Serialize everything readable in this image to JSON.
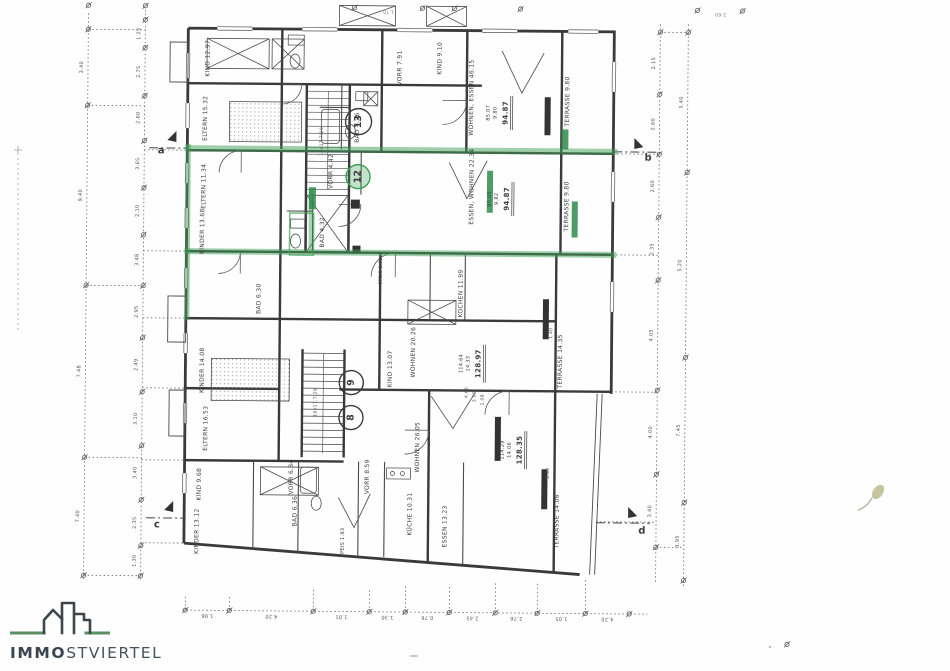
{
  "logo": {
    "brand_bold": "IMMO",
    "brand_rest": "STVIERTEL"
  },
  "colors": {
    "ink": "#3c3c3c",
    "dim": "#555555",
    "highlight_green": "#3f9f55",
    "logo_green": "#5d8f62"
  },
  "plan": {
    "texts": [
      {
        "t": "KIND 12.97",
        "x": 206,
        "y": 60,
        "r": -90,
        "n": "room-label"
      },
      {
        "t": "ELTERN 15.32",
        "x": 204,
        "y": 120,
        "r": -90,
        "n": "room-label"
      },
      {
        "t": "ELTERN 11.34",
        "x": 203,
        "y": 188,
        "r": -90,
        "n": "room-label"
      },
      {
        "t": "KINDER 13.68",
        "x": 202,
        "y": 233,
        "r": -90,
        "n": "room-label"
      },
      {
        "t": "KINDER 14.08",
        "x": 203,
        "y": 372,
        "r": -90,
        "n": "room-label"
      },
      {
        "t": "ELTERN 16.53",
        "x": 207,
        "y": 430,
        "r": -90,
        "n": "room-label"
      },
      {
        "t": "KIND 9.68",
        "x": 201,
        "y": 486,
        "r": -90,
        "n": "room-label"
      },
      {
        "t": "KINDER 13.12",
        "x": 199,
        "y": 533,
        "r": -90,
        "n": "room-label"
      },
      {
        "t": "BAD 6.30",
        "x": 259,
        "y": 300,
        "r": -90,
        "n": "room-label"
      },
      {
        "t": "BAD 6.36",
        "x": 297,
        "y": 512,
        "r": -90,
        "n": "room-label"
      },
      {
        "t": "VORR 6.34",
        "x": 293,
        "y": 478,
        "r": -90,
        "n": "room-label"
      },
      {
        "t": "VORR 8.59",
        "x": 369,
        "y": 477,
        "r": -90,
        "n": "room-label"
      },
      {
        "t": "SPEIS 1.93",
        "x": 345,
        "y": 543,
        "r": -90,
        "s": 5,
        "n": "room-label"
      },
      {
        "t": "KÜCHE 10.31",
        "x": 412,
        "y": 514,
        "r": -90,
        "n": "room-label"
      },
      {
        "t": "ESSEN 13.23",
        "x": 447,
        "y": 526,
        "r": -90,
        "n": "room-label"
      },
      {
        "t": "WOHNEN 26.05",
        "x": 419,
        "y": 447,
        "r": -90,
        "n": "room-label"
      },
      {
        "t": "WOHNEN 20.26",
        "x": 414,
        "y": 352,
        "r": -90,
        "n": "room-label"
      },
      {
        "t": "KIND 13.07",
        "x": 391,
        "y": 369,
        "r": -90,
        "n": "room-label"
      },
      {
        "t": "KOCHEN 11.99",
        "x": 461,
        "y": 293,
        "r": -90,
        "n": "room-label"
      },
      {
        "t": "SPEIS 1.90",
        "x": 381,
        "y": 271,
        "r": -90,
        "s": 4.5,
        "n": "room-label"
      },
      {
        "t": "VORR 4.42",
        "x": 330,
        "y": 172,
        "r": -90,
        "n": "room-label"
      },
      {
        "t": "BAD 4.32",
        "x": 322,
        "y": 233,
        "r": -90,
        "n": "room-label"
      },
      {
        "t": "ESSEN, WOHNEN 22.34",
        "x": 471,
        "y": 186,
        "r": -90,
        "n": "room-label"
      },
      {
        "t": "WOHNEN, ESSEN 46.15",
        "x": 470,
        "y": 97,
        "r": -90,
        "n": "room-label"
      },
      {
        "t": "KIND 9.10",
        "x": 438,
        "y": 58,
        "r": -90,
        "n": "room-label"
      },
      {
        "t": "VORR 7.91",
        "x": 398,
        "y": 68,
        "r": -90,
        "n": "room-label"
      },
      {
        "t": "BAD 4.26",
        "x": 356,
        "y": 128,
        "r": -90,
        "n": "room-label"
      },
      {
        "t": "TERRASSE 9.80",
        "x": 566,
        "y": 100,
        "r": -90,
        "n": "room-label"
      },
      {
        "t": "TERRASSE 9.80",
        "x": 566,
        "y": 205,
        "r": -90,
        "n": "room-label"
      },
      {
        "t": "TERRASSE 14.35",
        "x": 561,
        "y": 360,
        "r": -90,
        "n": "room-label"
      },
      {
        "t": "TERRASSE 14.06",
        "x": 559,
        "y": 520,
        "r": -90,
        "n": "room-label"
      },
      {
        "t": "16x17.7/29",
        "x": 321,
        "y": 142,
        "r": -90,
        "s": 4.5,
        "c": "#555555",
        "n": "stair-note"
      },
      {
        "t": "16x17.7/29",
        "x": 317,
        "y": 403,
        "r": -90,
        "s": 4.5,
        "c": "#555555",
        "n": "stair-note"
      },
      {
        "t": "85.07",
        "x": 487,
        "y": 112,
        "r": -90,
        "s": 5,
        "n": "area-sum"
      },
      {
        "t": "9.80",
        "x": 494,
        "y": 112,
        "r": -90,
        "s": 5,
        "n": "area-sum"
      },
      {
        "t": "94.87",
        "x": 504,
        "y": 112,
        "r": -90,
        "s": 7,
        "w": 1,
        "n": "area-total"
      },
      {
        "t": "85.05",
        "x": 489,
        "y": 198,
        "r": -90,
        "s": 5,
        "n": "area-sum"
      },
      {
        "t": "9.82",
        "x": 496,
        "y": 198,
        "r": -90,
        "s": 5,
        "n": "area-sum"
      },
      {
        "t": "94.87",
        "x": 506,
        "y": 198,
        "r": -90,
        "s": 7,
        "w": 1,
        "n": "area-total"
      },
      {
        "t": "114.64",
        "x": 462,
        "y": 363,
        "r": -90,
        "s": 5,
        "n": "area-sum"
      },
      {
        "t": "14.33",
        "x": 469,
        "y": 363,
        "r": -90,
        "s": 5,
        "n": "area-sum"
      },
      {
        "t": "128.97",
        "x": 479,
        "y": 363,
        "r": -90,
        "s": 7,
        "w": 1,
        "n": "area-total"
      },
      {
        "t": "114.29",
        "x": 504,
        "y": 449,
        "r": -90,
        "s": 5,
        "n": "area-sum"
      },
      {
        "t": "14.06",
        "x": 511,
        "y": 449,
        "r": -90,
        "s": 5,
        "n": "area-sum"
      },
      {
        "t": "128.35",
        "x": 521,
        "y": 449,
        "r": -90,
        "s": 7,
        "w": 1,
        "n": "area-total"
      },
      {
        "t": "a",
        "x": 160,
        "y": 153,
        "s": 10,
        "w": 1,
        "n": "section-marker-a"
      },
      {
        "t": "b",
        "x": 647,
        "y": 156,
        "s": 10,
        "w": 1,
        "n": "section-marker-b"
      },
      {
        "t": "c",
        "x": 159,
        "y": 527,
        "s": 10,
        "w": 1,
        "n": "section-marker-c"
      },
      {
        "t": "d",
        "x": 644,
        "y": 529,
        "s": 10,
        "w": 1,
        "n": "section-marker-d"
      },
      {
        "t": "4.66",
        "x": 468,
        "y": 392,
        "r": -90,
        "s": 4.5,
        "c": "#555555",
        "n": "dim-label"
      },
      {
        "t": "3.00",
        "x": 476,
        "y": 396,
        "r": -90,
        "s": 4.5,
        "c": "#555555",
        "n": "dim-label"
      },
      {
        "t": "2.08",
        "x": 484,
        "y": 399,
        "r": -90,
        "s": 4.5,
        "c": "#555555",
        "n": "dim-label"
      },
      {
        "t": "1.40",
        "x": 552,
        "y": 332,
        "r": -90,
        "s": 4.5,
        "c": "#555555",
        "n": "dim-label"
      },
      {
        "t": "1.40",
        "x": 550,
        "y": 472,
        "r": -90,
        "s": 4.5,
        "c": "#555555",
        "n": "dim-label"
      },
      {
        "t": "1.25",
        "x": 137,
        "y": 36,
        "r": -90,
        "s": 5,
        "c": "#555555",
        "n": "dim-label"
      },
      {
        "t": "2.75",
        "x": 137,
        "y": 74,
        "r": -90,
        "s": 5,
        "c": "#555555",
        "n": "dim-label"
      },
      {
        "t": "2.60",
        "x": 137,
        "y": 120,
        "r": -90,
        "s": 5,
        "c": "#555555",
        "n": "dim-label"
      },
      {
        "t": "3.65",
        "x": 137,
        "y": 166,
        "r": -90,
        "s": 5,
        "c": "#555555",
        "n": "dim-label"
      },
      {
        "t": "2.10",
        "x": 137,
        "y": 213,
        "r": -90,
        "s": 5,
        "c": "#555555",
        "n": "dim-label"
      },
      {
        "t": "3.48",
        "x": 137,
        "y": 262,
        "r": -90,
        "s": 5,
        "c": "#555555",
        "n": "dim-label"
      },
      {
        "t": "2.95",
        "x": 137,
        "y": 314,
        "r": -90,
        "s": 5,
        "c": "#555555",
        "n": "dim-label"
      },
      {
        "t": "2.49",
        "x": 137,
        "y": 367,
        "r": -90,
        "s": 5,
        "c": "#555555",
        "n": "dim-label"
      },
      {
        "t": "3.10",
        "x": 137,
        "y": 421,
        "r": -90,
        "s": 5,
        "c": "#555555",
        "n": "dim-label"
      },
      {
        "t": "3.40",
        "x": 137,
        "y": 475,
        "r": -90,
        "s": 5,
        "c": "#555555",
        "n": "dim-label"
      },
      {
        "t": "2.35",
        "x": 137,
        "y": 525,
        "r": -90,
        "s": 5,
        "c": "#555555",
        "n": "dim-label"
      },
      {
        "t": "1.30",
        "x": 137,
        "y": 563,
        "r": -90,
        "s": 5,
        "c": "#555555",
        "n": "dim-label"
      },
      {
        "t": "3.40",
        "x": 80,
        "y": 70,
        "r": -90,
        "s": 5,
        "c": "#555555",
        "n": "dim-label"
      },
      {
        "t": "9.40",
        "x": 80,
        "y": 198,
        "r": -90,
        "s": 5,
        "c": "#555555",
        "n": "dim-label"
      },
      {
        "t": "7.48",
        "x": 80,
        "y": 374,
        "r": -90,
        "s": 5,
        "c": "#555555",
        "n": "dim-label"
      },
      {
        "t": "7.40",
        "x": 80,
        "y": 519,
        "r": -90,
        "s": 5,
        "c": "#555555",
        "n": "dim-label"
      },
      {
        "t": "2.15",
        "x": 652,
        "y": 61,
        "r": -90,
        "s": 5,
        "c": "#555555",
        "n": "dim-label"
      },
      {
        "t": "2.60",
        "x": 652,
        "y": 122,
        "r": -90,
        "s": 5,
        "c": "#555555",
        "n": "dim-label"
      },
      {
        "t": "2.60",
        "x": 652,
        "y": 184,
        "r": -90,
        "s": 5,
        "c": "#555555",
        "n": "dim-label"
      },
      {
        "t": "2.35",
        "x": 652,
        "y": 247,
        "r": -90,
        "s": 5,
        "c": "#555555",
        "n": "dim-label"
      },
      {
        "t": "4.05",
        "x": 652,
        "y": 333,
        "r": -90,
        "s": 5,
        "c": "#555555",
        "n": "dim-label"
      },
      {
        "t": "4.00",
        "x": 652,
        "y": 430,
        "r": -90,
        "s": 5,
        "c": "#555555",
        "n": "dim-label"
      },
      {
        "t": "3.40",
        "x": 652,
        "y": 509,
        "r": -90,
        "s": 5,
        "c": "#555555",
        "n": "dim-label"
      },
      {
        "t": "5.40",
        "x": 680,
        "y": 100,
        "r": -90,
        "s": 5,
        "c": "#555555",
        "n": "dim-label"
      },
      {
        "t": "5.20",
        "x": 680,
        "y": 263,
        "r": -90,
        "s": 5,
        "c": "#555555",
        "n": "dim-label"
      },
      {
        "t": "7.45",
        "x": 680,
        "y": 428,
        "r": -90,
        "s": 5,
        "c": "#555555",
        "n": "dim-label"
      },
      {
        "t": "3.95",
        "x": 680,
        "y": 539,
        "r": -90,
        "s": 5,
        "c": "#555555",
        "n": "dim-label"
      },
      {
        "t": "1.06",
        "x": 210,
        "y": 617,
        "r": 180,
        "s": 5,
        "c": "#555555",
        "n": "dim-label"
      },
      {
        "t": "4.20",
        "x": 274,
        "y": 617,
        "r": 180,
        "s": 5,
        "c": "#555555",
        "n": "dim-label"
      },
      {
        "t": "1.01",
        "x": 344,
        "y": 617,
        "r": 180,
        "s": 5,
        "c": "#555555",
        "n": "dim-label"
      },
      {
        "t": "1.30",
        "x": 390,
        "y": 617,
        "r": 180,
        "s": 5,
        "c": "#555555",
        "n": "dim-label"
      },
      {
        "t": "0.76",
        "x": 430,
        "y": 617,
        "r": 180,
        "s": 5,
        "c": "#555555",
        "n": "dim-label"
      },
      {
        "t": "2.45",
        "x": 475,
        "y": 617,
        "r": 180,
        "s": 5,
        "c": "#555555",
        "n": "dim-label"
      },
      {
        "t": "2.76",
        "x": 519,
        "y": 617,
        "r": 180,
        "s": 5,
        "c": "#555555",
        "n": "dim-label"
      },
      {
        "t": "1.05",
        "x": 564,
        "y": 617,
        "r": 180,
        "s": 5,
        "c": "#555555",
        "n": "dim-label"
      },
      {
        "t": "4.20",
        "x": 610,
        "y": 617,
        "r": 180,
        "s": 5,
        "c": "#555555",
        "n": "dim-label"
      },
      {
        "t": "2.60",
        "x": 718,
        "y": 11,
        "r": 180,
        "s": 4.5,
        "c": "#777777",
        "n": "dim-label"
      },
      {
        "t": "1.70",
        "x": 386,
        "y": 11,
        "r": 180,
        "s": 4.5,
        "c": "#777777",
        "n": "dim-label"
      }
    ],
    "ticks": [
      {
        "x": 86,
        "y": 32
      },
      {
        "x": 86,
        "y": 108
      },
      {
        "x": 86,
        "y": 288
      },
      {
        "x": 86,
        "y": 460
      },
      {
        "x": 86,
        "y": 578
      },
      {
        "x": 143,
        "y": 22
      },
      {
        "x": 143,
        "y": 50
      },
      {
        "x": 143,
        "y": 98
      },
      {
        "x": 143,
        "y": 143
      },
      {
        "x": 143,
        "y": 190
      },
      {
        "x": 143,
        "y": 237
      },
      {
        "x": 143,
        "y": 288
      },
      {
        "x": 143,
        "y": 340
      },
      {
        "x": 143,
        "y": 394
      },
      {
        "x": 143,
        "y": 448
      },
      {
        "x": 143,
        "y": 502
      },
      {
        "x": 143,
        "y": 548
      },
      {
        "x": 143,
        "y": 578
      },
      {
        "x": 658,
        "y": 30
      },
      {
        "x": 658,
        "y": 92
      },
      {
        "x": 658,
        "y": 152
      },
      {
        "x": 658,
        "y": 215
      },
      {
        "x": 658,
        "y": 278
      },
      {
        "x": 658,
        "y": 388
      },
      {
        "x": 658,
        "y": 472
      },
      {
        "x": 658,
        "y": 545
      },
      {
        "x": 686,
        "y": 30
      },
      {
        "x": 686,
        "y": 170
      },
      {
        "x": 686,
        "y": 355
      },
      {
        "x": 686,
        "y": 500
      },
      {
        "x": 686,
        "y": 578
      },
      {
        "x": 188,
        "y": 612
      },
      {
        "x": 232,
        "y": 612
      },
      {
        "x": 316,
        "y": 612
      },
      {
        "x": 372,
        "y": 612
      },
      {
        "x": 408,
        "y": 612
      },
      {
        "x": 452,
        "y": 612
      },
      {
        "x": 498,
        "y": 612
      },
      {
        "x": 540,
        "y": 612
      },
      {
        "x": 588,
        "y": 612
      },
      {
        "x": 632,
        "y": 612
      },
      {
        "x": 352,
        "y": 8
      },
      {
        "x": 420,
        "y": 8
      },
      {
        "x": 452,
        "y": 8
      },
      {
        "x": 518,
        "y": 8
      },
      {
        "x": 695,
        "y": 8
      },
      {
        "x": 740,
        "y": 8
      },
      {
        "x": 790,
        "y": 641
      },
      {
        "x": 86,
        "y": 8
      },
      {
        "x": 143,
        "y": 8
      }
    ],
    "circles": [
      {
        "x": 357,
        "y": 122,
        "r": 13,
        "label": "13",
        "green": false
      },
      {
        "x": 357,
        "y": 177,
        "r": 12,
        "label": "12",
        "green": true
      },
      {
        "x": 352,
        "y": 383,
        "r": 12,
        "label": "9",
        "green": false
      },
      {
        "x": 352,
        "y": 418,
        "r": 12,
        "label": "8",
        "green": false
      }
    ]
  }
}
